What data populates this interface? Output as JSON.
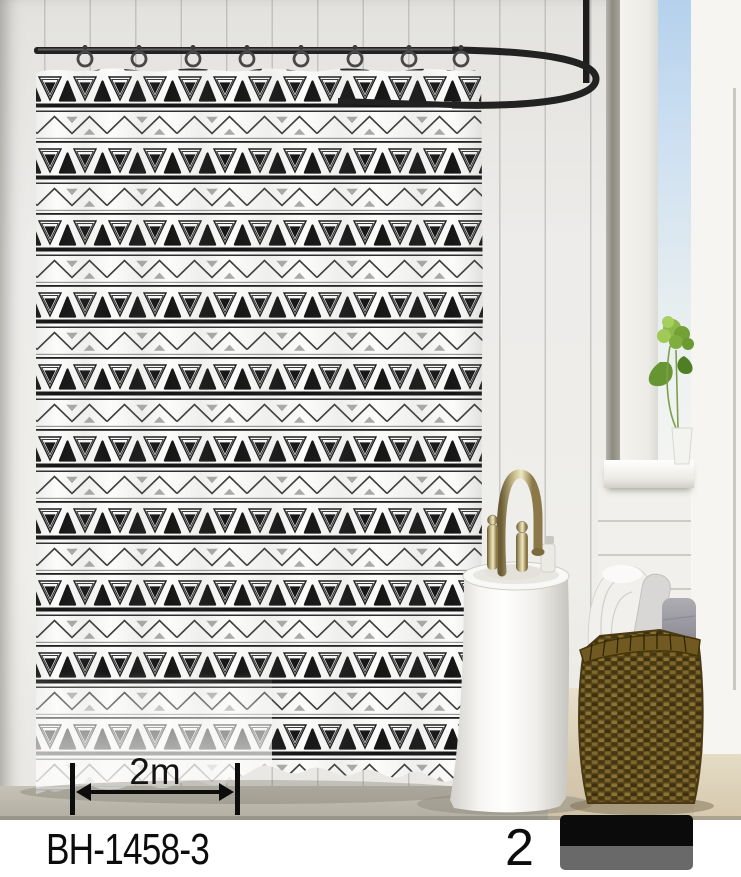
{
  "product": {
    "code": "BH-1458-3",
    "quantity": "2",
    "width_label": "2m"
  },
  "swatch": {
    "top_color": "#0b0b0b",
    "bottom_color": "#696969"
  },
  "scene": {
    "objects": [
      "shower-rod",
      "curtain-hooks",
      "shower-curtain",
      "pedestal-basin",
      "gold-faucet",
      "soap-pump",
      "wicker-basket",
      "rolled-towels",
      "window",
      "green-plant",
      "measurement-arrow"
    ],
    "hook_count": 8,
    "colors": {
      "pattern_black": "#1a1a1a",
      "pattern_gray": "#ababab",
      "curtain_white": "#fcfcfb",
      "wall": "#e9e8e5",
      "sky": "#b5d1ec",
      "floor": "#d6c9b0",
      "basket_brown": "#6b561f",
      "rod_black": "#1f1f1f"
    }
  }
}
